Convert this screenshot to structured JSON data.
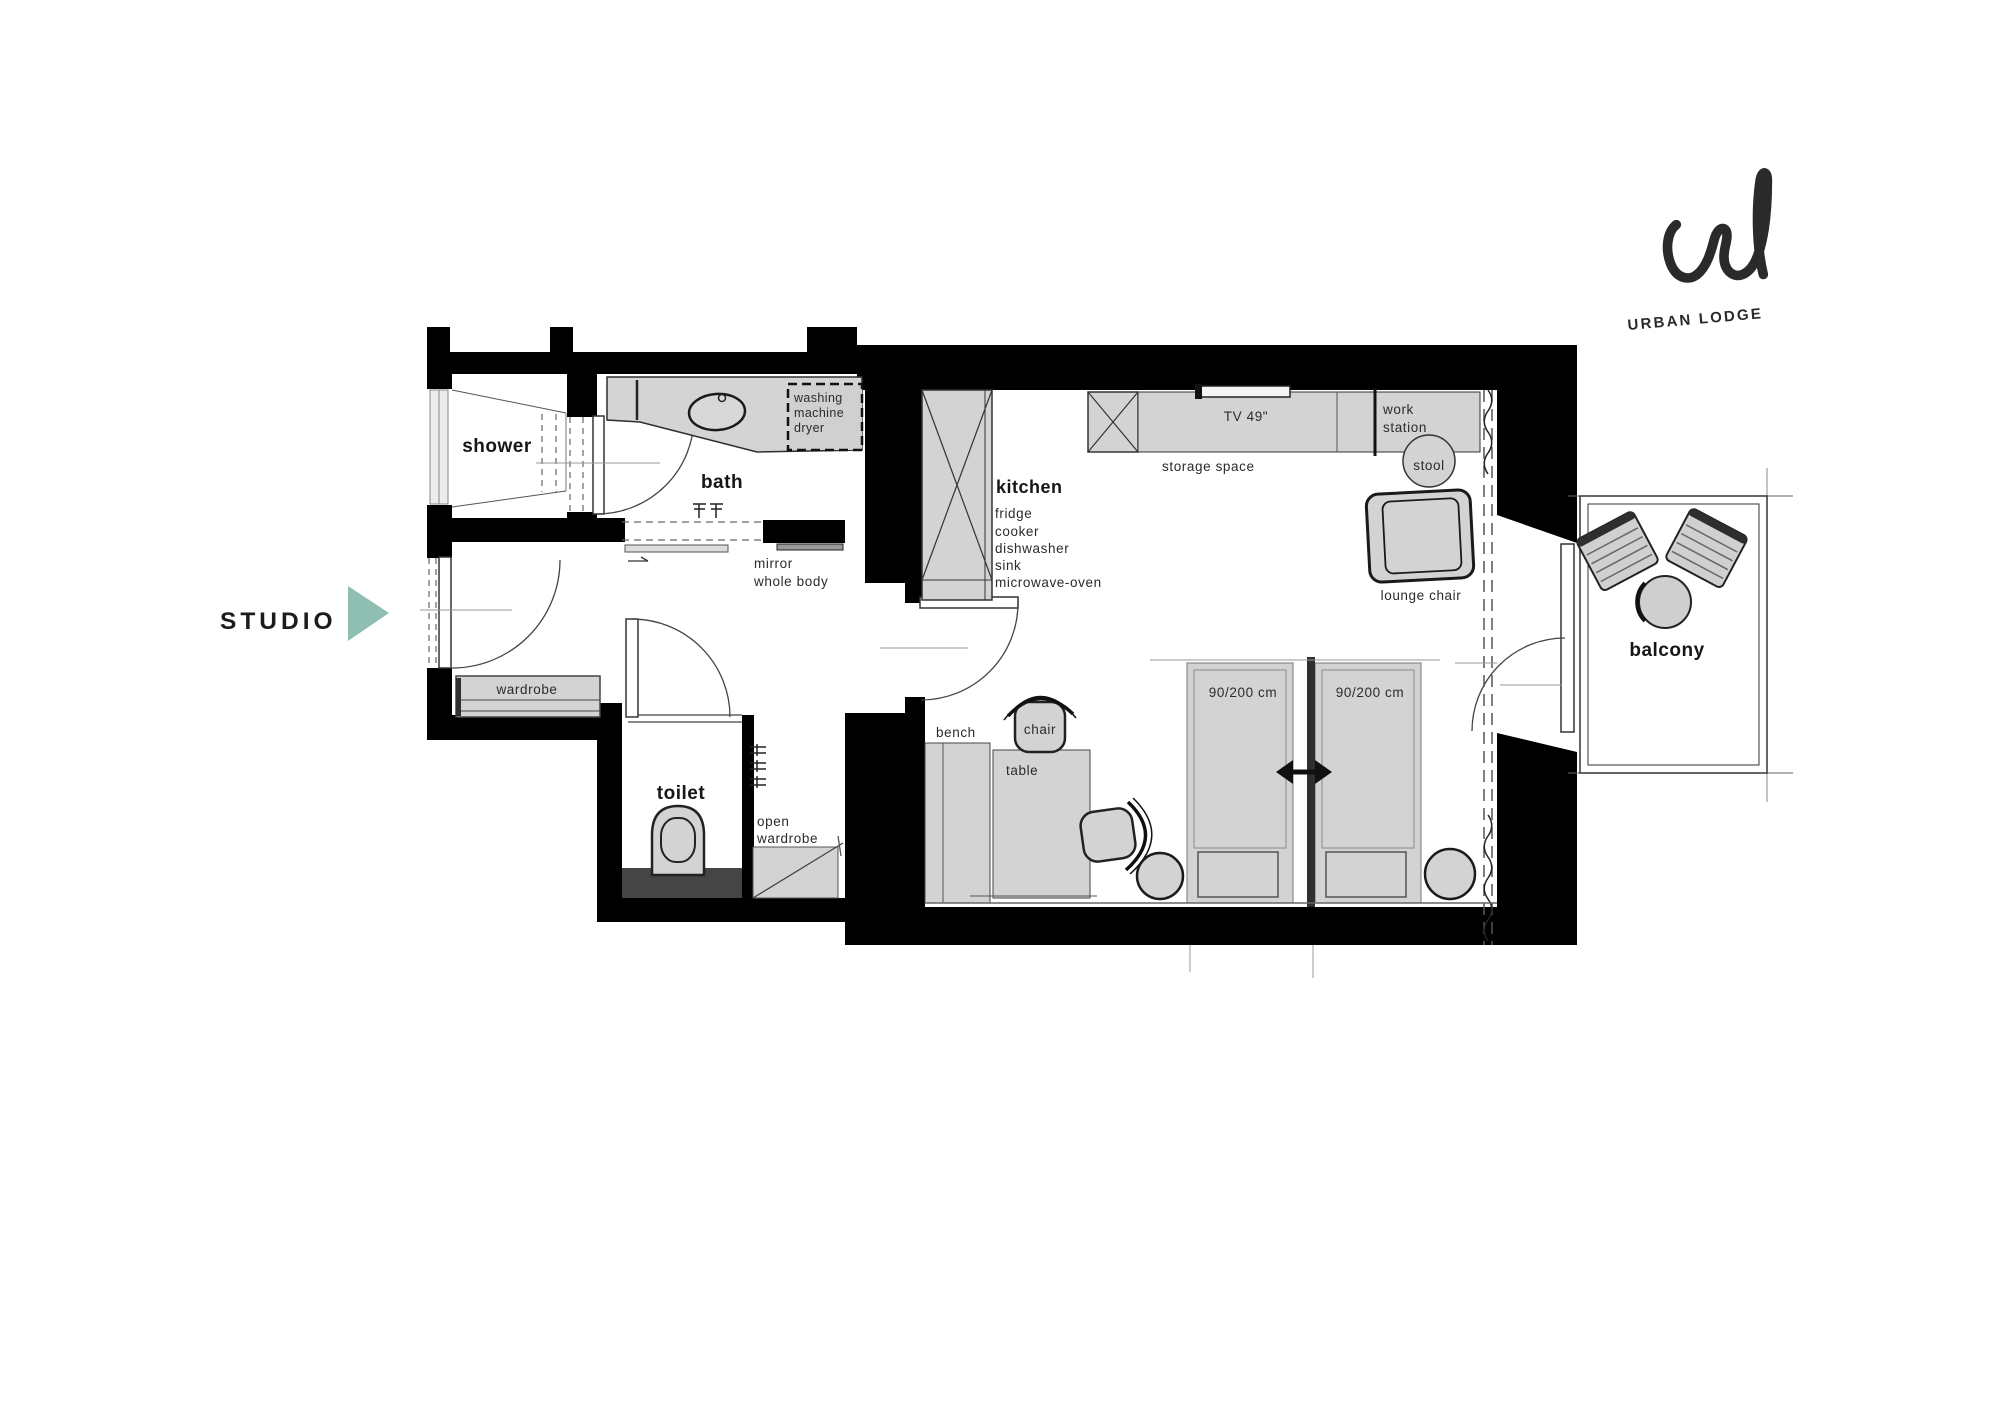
{
  "studio": {
    "label": "STUDIO"
  },
  "brand": {
    "name": "URBAN LODGE"
  },
  "rooms": {
    "shower": "shower",
    "bath": "bath",
    "toilet": "toilet",
    "kitchen": "kitchen",
    "balcony": "balcony"
  },
  "kitchen_items": [
    "fridge",
    "cooker",
    "dishwasher",
    "sink",
    "microwave-oven"
  ],
  "furniture": {
    "washing_machine_lines": [
      "washing",
      "machine",
      "dryer"
    ],
    "mirror_lines": [
      "mirror",
      "whole body"
    ],
    "wardrobe": "wardrobe",
    "open_wardrobe_lines": [
      "open",
      "wardrobe"
    ],
    "bench": "bench",
    "chair": "chair",
    "table": "table",
    "storage_space": "storage space",
    "tv": "TV 49\"",
    "work_station_lines": [
      "work",
      "station"
    ],
    "stool": "stool",
    "lounge_chair": "lounge chair",
    "bed_size": "90/200 cm"
  },
  "colors": {
    "accent_arrow": "#8FBFB2",
    "wall": "#000000",
    "furniture_fill": "#D3D3D3",
    "dark_fixture": "#454545",
    "background": "#FFFFFF"
  }
}
